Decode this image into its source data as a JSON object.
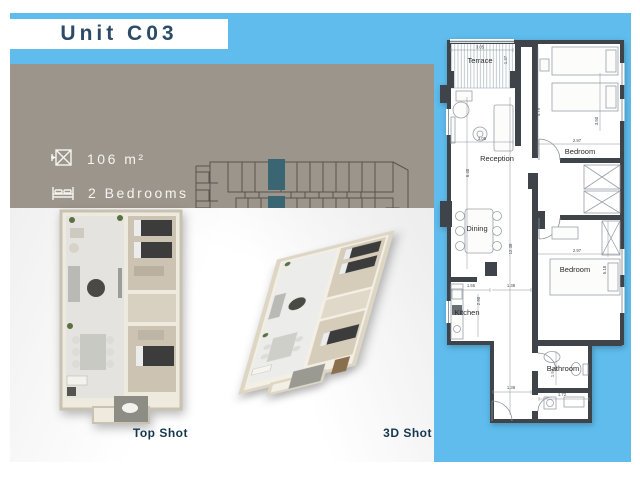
{
  "header": {
    "title": "Unit C03"
  },
  "specs": {
    "area": "106 m²",
    "bedrooms": "2 Bedrooms",
    "bathroom": "1 Bathroom"
  },
  "keyplan": {
    "caption": "Typical"
  },
  "renders": {
    "top_shot": "Top Shot",
    "three_d": "3D Shot"
  },
  "floorplan": {
    "rooms": {
      "terrace": "Terrace",
      "reception": "Reception",
      "dining": "Dining",
      "kitchen": "Kitchen",
      "bathroom": "Bathroom",
      "bedroom1": "Bedroom",
      "bedroom2": "Bedroom"
    },
    "dims": {
      "terrace_w": "3.05",
      "terrace_d": "1.37",
      "reception_w": "3.05",
      "reception_l": "6.40",
      "living_l": "12.38",
      "bed1_l": "4.79",
      "bed1_d": "3.50",
      "bed1_w": "2.97",
      "bed2_w": "2.97",
      "bed2_l": "5.18",
      "kitchen_w": "1.55",
      "hall_w": "1.38",
      "kitchen_l": "2.90",
      "bath_l": "1.94",
      "bath_w": "1.72",
      "entry_w": "1.38"
    }
  },
  "colors": {
    "accent_blue": "#5fbcec",
    "panel_gray": "#9b958c",
    "highlight_teal": "#3a6674",
    "title_navy": "#2b4b66",
    "wall_dark": "#3e4449"
  }
}
